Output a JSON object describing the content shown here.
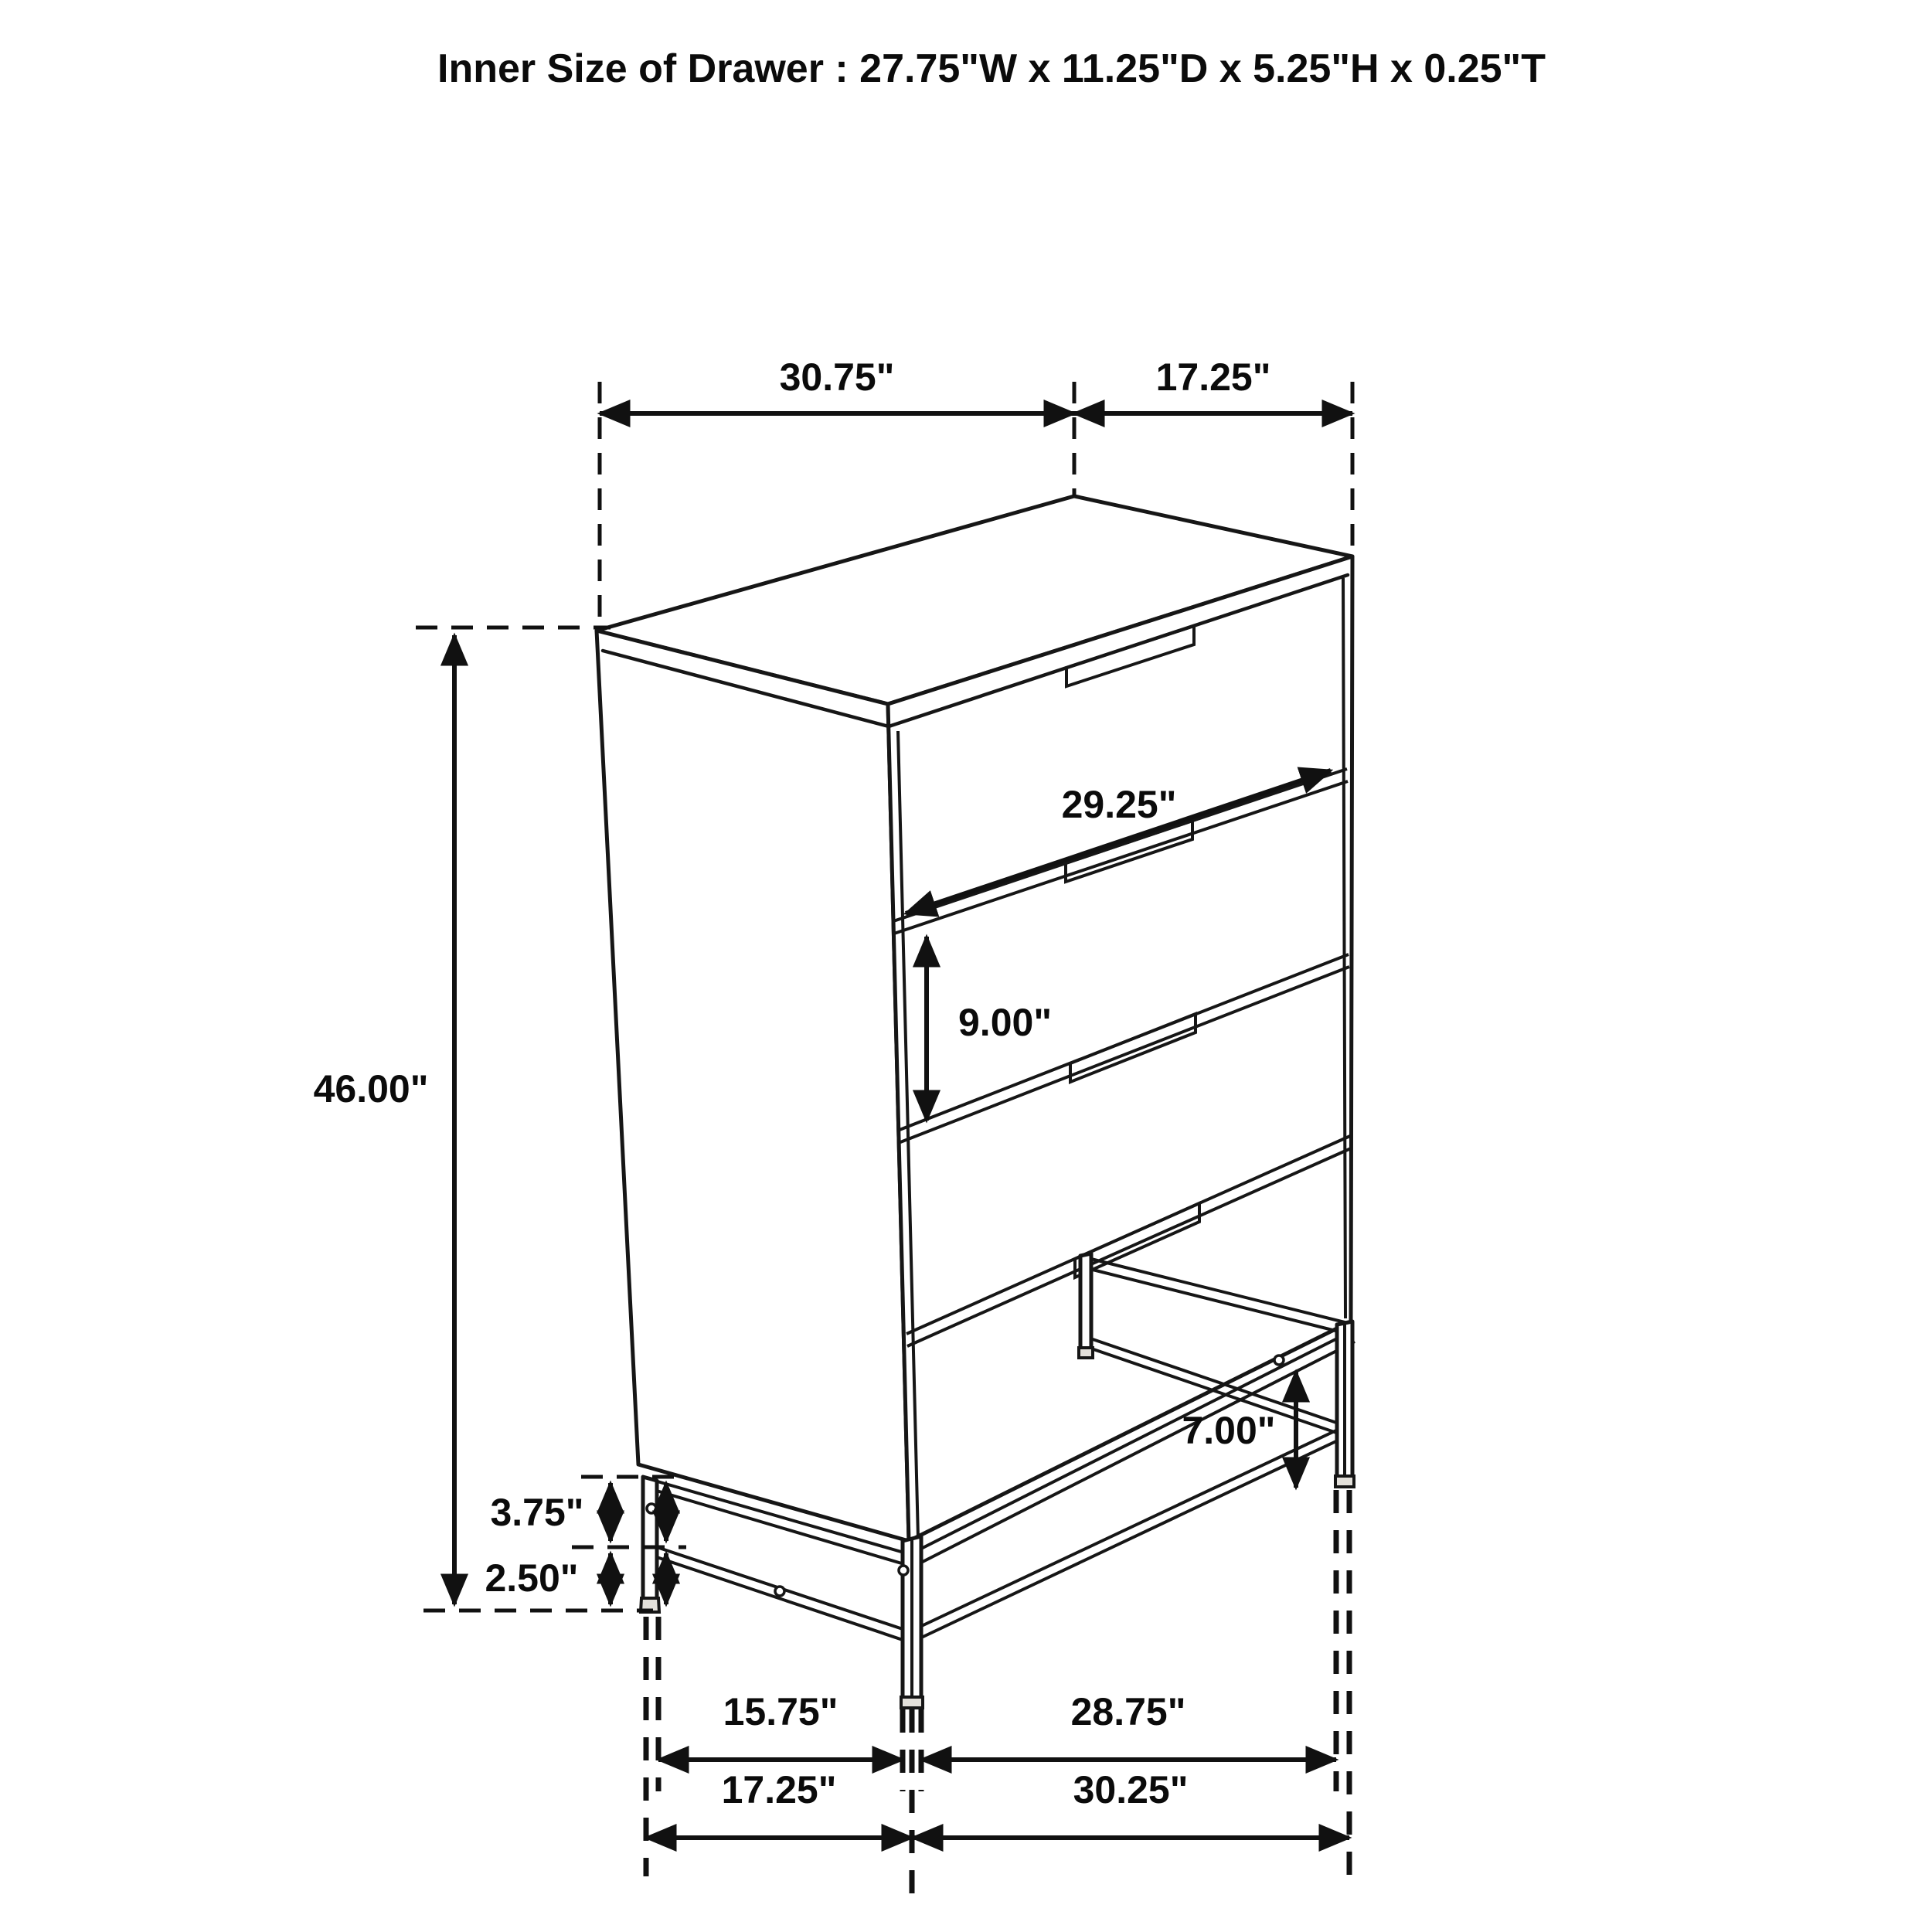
{
  "title": "Inner Size of Drawer : 27.75\"W x 11.25\"D x 5.25\"H x 0.25\"T",
  "dimensions": {
    "top_width": "30.75\"",
    "top_depth": "17.25\"",
    "overall_height": "46.00\"",
    "drawer_front_width": "29.25\"",
    "drawer_section_height": "9.00\"",
    "leg_height": "7.00\"",
    "base_upper_gap": "3.75\"",
    "base_lower_gap": "2.50\"",
    "feet_span_inner_left": "15.75\"",
    "feet_span_inner_right": "28.75\"",
    "feet_span_outer_left": "17.25\"",
    "feet_span_outer_right": "30.25\""
  }
}
